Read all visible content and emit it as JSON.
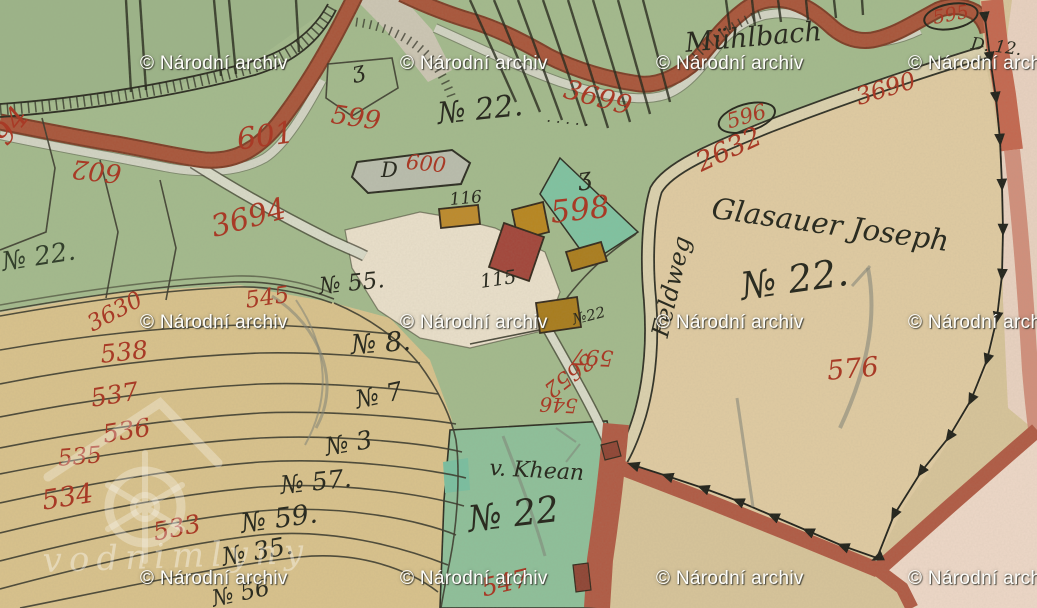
{
  "palette": {
    "paper_beige": "#d7c49a",
    "meadow_green": "#a3ba8d",
    "forest_green": "#9cb488",
    "teal_parcel": "#7fc3a1",
    "bottom_parcel_green": "#8ec09a",
    "fields_tan": "#d9c28c",
    "right_parcel_beige": "#e0cba2",
    "farm_white": "#eae0cb",
    "pink_area": "#e9d2c1",
    "road_red": "#a9553a",
    "rose_road": "#cd8470",
    "ink_black": "#2b2c21",
    "number_red": "#a83a26"
  },
  "watermarks": {
    "archive": {
      "text": "© Národní archiv",
      "positions": [
        [
          140,
          53
        ],
        [
          400,
          53
        ],
        [
          656,
          53
        ],
        [
          908,
          53
        ],
        [
          140,
          312
        ],
        [
          400,
          312
        ],
        [
          656,
          312
        ],
        [
          908,
          312
        ],
        [
          140,
          568
        ],
        [
          400,
          568
        ],
        [
          656,
          568
        ],
        [
          908,
          568
        ]
      ]
    },
    "logo": {
      "text": "vodnimlyny"
    }
  },
  "map_labels": [
    {
      "t": "94",
      "x": -12,
      "y": 132,
      "r": -52,
      "s": 30,
      "c": "red"
    },
    {
      "t": "601",
      "x": 235,
      "y": 126,
      "r": -8,
      "s": 30,
      "c": "red"
    },
    {
      "t": "602",
      "x": 120,
      "y": 186,
      "r": 186,
      "s": 26,
      "c": "red"
    },
    {
      "t": "599",
      "x": 333,
      "y": 102,
      "r": 8,
      "s": 26,
      "c": "red"
    },
    {
      "t": "600",
      "x": 407,
      "y": 152,
      "r": 5,
      "s": 21,
      "c": "red"
    },
    {
      "t": "3694",
      "x": 208,
      "y": 214,
      "r": -15,
      "s": 30,
      "c": "red"
    },
    {
      "t": "3699",
      "x": 568,
      "y": 76,
      "r": 15,
      "s": 27,
      "c": "red"
    },
    {
      "t": "3690",
      "x": 853,
      "y": 86,
      "r": -17,
      "s": 24,
      "c": "red"
    },
    {
      "t": "595",
      "x": 921,
      "y": 8,
      "r": -10,
      "s": 19,
      "c": "red",
      "oval": true
    },
    {
      "t": "596",
      "x": 714,
      "y": 112,
      "r": -16,
      "s": 21,
      "c": "red",
      "oval": true
    },
    {
      "t": "2632",
      "x": 692,
      "y": 152,
      "r": -25,
      "s": 27,
      "c": "red"
    },
    {
      "t": "598",
      "x": 549,
      "y": 198,
      "r": -6,
      "s": 31,
      "c": "red"
    },
    {
      "t": "597",
      "x": 613,
      "y": 368,
      "r": 183,
      "s": 22,
      "c": "red"
    },
    {
      "t": "3652",
      "x": 597,
      "y": 366,
      "r": 142,
      "s": 22,
      "c": "red"
    },
    {
      "t": "546",
      "x": 577,
      "y": 416,
      "r": 183,
      "s": 20,
      "c": "red"
    },
    {
      "t": "545",
      "x": 244,
      "y": 290,
      "r": -8,
      "s": 23,
      "c": "red"
    },
    {
      "t": "3630",
      "x": 84,
      "y": 316,
      "r": -28,
      "s": 23,
      "c": "red"
    },
    {
      "t": "538",
      "x": 99,
      "y": 342,
      "r": -6,
      "s": 25,
      "c": "red"
    },
    {
      "t": "537",
      "x": 89,
      "y": 386,
      "r": -9,
      "s": 25,
      "c": "red"
    },
    {
      "t": "536",
      "x": 101,
      "y": 422,
      "r": -9,
      "s": 25,
      "c": "red"
    },
    {
      "t": "535",
      "x": 57,
      "y": 448,
      "r": -5,
      "s": 23,
      "c": "red"
    },
    {
      "t": "534",
      "x": 40,
      "y": 488,
      "r": -9,
      "s": 27,
      "c": "red"
    },
    {
      "t": "533",
      "x": 151,
      "y": 520,
      "r": -11,
      "s": 25,
      "c": "red"
    },
    {
      "t": "547",
      "x": 479,
      "y": 576,
      "r": -13,
      "s": 25,
      "c": "red"
    },
    {
      "t": "576",
      "x": 826,
      "y": 358,
      "r": -5,
      "s": 27,
      "c": "red"
    },
    {
      "t": "Mühlbach",
      "x": 684,
      "y": 30,
      "r": -5,
      "s": 27,
      "c": "ink"
    },
    {
      "t": "№ 22.",
      "x": 436,
      "y": 100,
      "r": -6,
      "s": 30,
      "c": "ink"
    },
    {
      "t": "· · · · ·",
      "x": 547,
      "y": 114,
      "r": 6,
      "s": 15,
      "c": "ink"
    },
    {
      "t": "ʒ",
      "x": 350,
      "y": 62,
      "r": -12,
      "s": 22,
      "c": "ink"
    },
    {
      "t": "D",
      "x": 381,
      "y": 160,
      "r": 0,
      "s": 21,
      "c": "ink"
    },
    {
      "t": "116",
      "x": 449,
      "y": 192,
      "r": -5,
      "s": 17,
      "c": "ink"
    },
    {
      "t": "115",
      "x": 479,
      "y": 273,
      "r": -8,
      "s": 19,
      "c": "ink"
    },
    {
      "t": "ʒ",
      "x": 576,
      "y": 166,
      "r": -8,
      "s": 24,
      "c": "ink"
    },
    {
      "t": "№22",
      "x": 571,
      "y": 313,
      "r": -14,
      "s": 15,
      "c": "ink"
    },
    {
      "t": "D. 12.",
      "x": 972,
      "y": 36,
      "r": 7,
      "s": 17,
      "c": "ink"
    },
    {
      "t": "Glasauer Joseph",
      "x": 714,
      "y": 194,
      "r": 8,
      "s": 29,
      "c": "ink"
    },
    {
      "t": "№ 22.",
      "x": 738,
      "y": 268,
      "r": -8,
      "s": 38,
      "c": "ink"
    },
    {
      "t": "Feldweg",
      "x": 648,
      "y": 334,
      "r": -77,
      "s": 24,
      "c": "ink"
    },
    {
      "t": "v. Khean",
      "x": 490,
      "y": 458,
      "r": 3,
      "s": 22,
      "c": "ink"
    },
    {
      "t": "№ 22",
      "x": 466,
      "y": 503,
      "r": -7,
      "s": 36,
      "c": "ink"
    },
    {
      "t": "№ 55.",
      "x": 318,
      "y": 276,
      "r": -6,
      "s": 23,
      "c": "ink"
    },
    {
      "t": "№ 8.",
      "x": 350,
      "y": 332,
      "r": -4,
      "s": 27,
      "c": "ink"
    },
    {
      "t": "№ 7",
      "x": 353,
      "y": 388,
      "r": -12,
      "s": 25,
      "c": "ink"
    },
    {
      "t": "№ 3",
      "x": 323,
      "y": 435,
      "r": -10,
      "s": 25,
      "c": "ink"
    },
    {
      "t": "№ 57.",
      "x": 279,
      "y": 473,
      "r": -6,
      "s": 25,
      "c": "ink"
    },
    {
      "t": "№ 59.",
      "x": 239,
      "y": 511,
      "r": -8,
      "s": 27,
      "c": "ink"
    },
    {
      "t": "№ 35.",
      "x": 220,
      "y": 545,
      "r": -10,
      "s": 25,
      "c": "ink"
    },
    {
      "t": "№ 56",
      "x": 210,
      "y": 589,
      "r": -12,
      "s": 23,
      "c": "ink"
    },
    {
      "t": "№ 22.",
      "x": 0,
      "y": 250,
      "r": -9,
      "s": 26,
      "c": "dg"
    }
  ]
}
